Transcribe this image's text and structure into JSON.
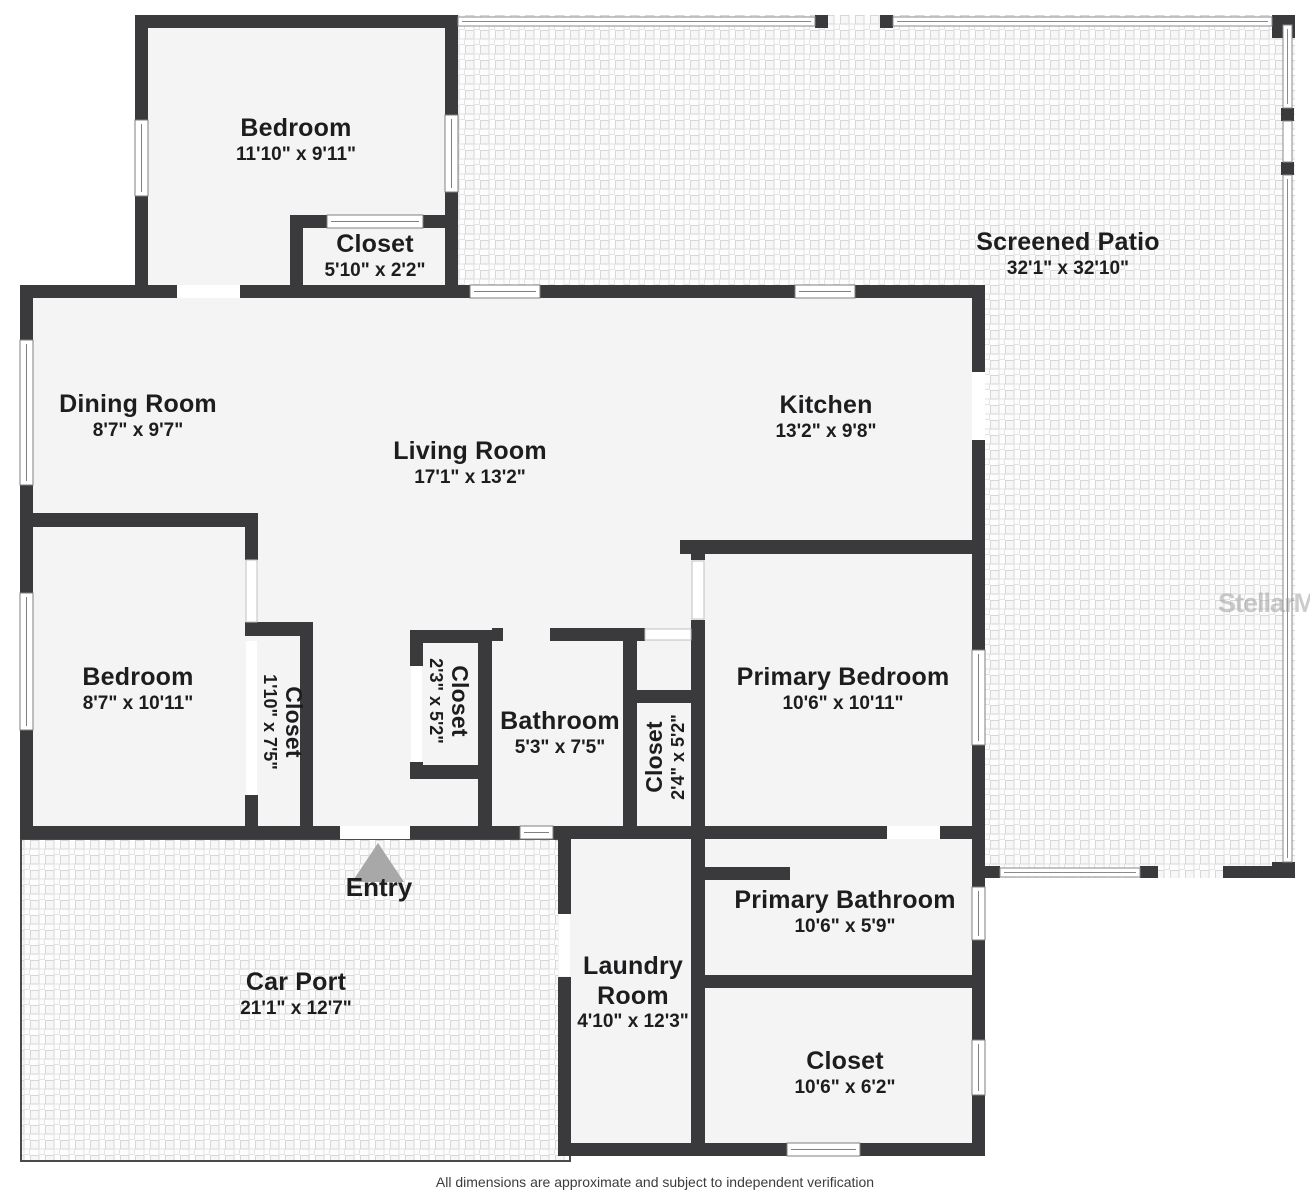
{
  "rooms": [
    {
      "name": "Bedroom",
      "dims": "11'10\" x 9'11\""
    },
    {
      "name": "Closet",
      "dims": "5'10\" x 2'2\""
    },
    {
      "name": "Screened Patio",
      "dims": "32'1\" x 32'10\""
    },
    {
      "name": "Dining Room",
      "dims": "8'7\" x 9'7\""
    },
    {
      "name": "Living Room",
      "dims": "17'1\" x 13'2\""
    },
    {
      "name": "Kitchen",
      "dims": "13'2\" x 9'8\""
    },
    {
      "name": "Bedroom",
      "dims": "8'7\" x 10'11\""
    },
    {
      "name": "Closet",
      "dims": "1'10\" x 7'5\""
    },
    {
      "name": "Closet",
      "dims": "2'3\" x 5'2\""
    },
    {
      "name": "Bathroom",
      "dims": "5'3\" x 7'5\""
    },
    {
      "name": "Closet",
      "dims": "2'4\" x 5'2\""
    },
    {
      "name": "Primary Bedroom",
      "dims": "10'6\" x 10'11\""
    },
    {
      "name": "Car Port",
      "dims": "21'1\" x 12'7\""
    },
    {
      "name": "Laundry\nRoom",
      "dims": "4'10\" x 12'3\""
    },
    {
      "name": "Primary Bathroom",
      "dims": "10'6\" x 5'9\""
    },
    {
      "name": "Closet",
      "dims": "10'6\" x 6'2\""
    }
  ],
  "entry": {
    "label": "Entry"
  },
  "watermark": "StellarMLS",
  "footer": "All dimensions are approximate and subject to independent verification",
  "colors": {
    "wall": "#3a3a3c",
    "room_fill": "#f4f4f4",
    "entry_arrow": "#a8a8a8"
  }
}
